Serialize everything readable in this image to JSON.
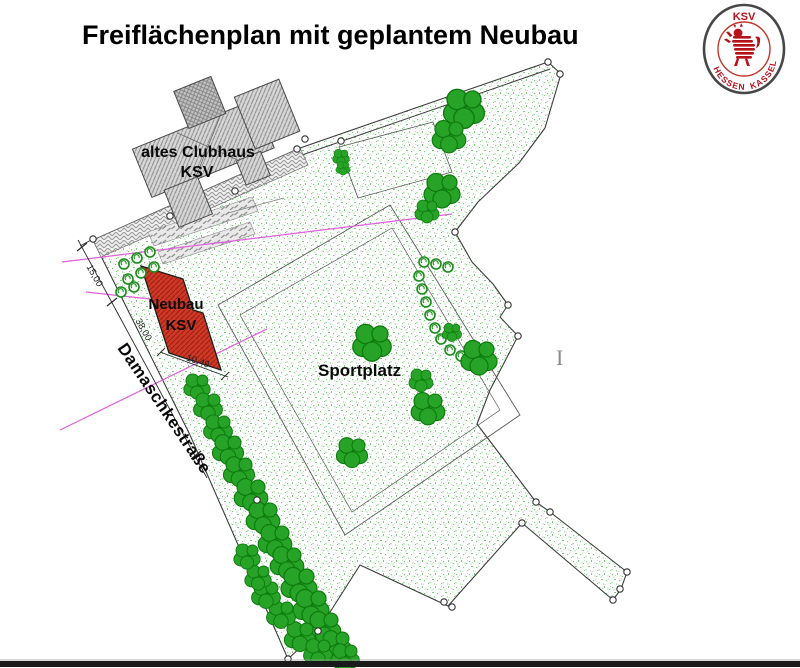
{
  "title": "Freiflächenplan mit geplantem Neubau",
  "logo": {
    "top": "KSV",
    "bottom_left": "HESSEN",
    "bottom_right": "KASSEL"
  },
  "plan": {
    "labels": {
      "old_clubhouse_line1": "altes Clubhaus",
      "old_clubhouse_line2": "KSV",
      "new_building_line1": "Neubau",
      "new_building_line2": "KSV",
      "sports_field": "Sportplatz",
      "street": "Damaschkestraße",
      "cursor_artifact": "I"
    },
    "dimensions": [
      {
        "label": "15,00"
      },
      {
        "label": "38,00"
      },
      {
        "label": "10,49"
      }
    ],
    "colors": {
      "building_red": "#cf3a28",
      "building_red_hatch": "#a32114",
      "tree_green": "#22a022",
      "stipple_green": "#3aa53a",
      "magenta": "#e25fdf",
      "hatch_gray": "#8f8f8f",
      "boundary_gray": "#3c3c3c",
      "logo_red": "#b5121b",
      "bottom_bar": "#1a1a1a"
    }
  }
}
